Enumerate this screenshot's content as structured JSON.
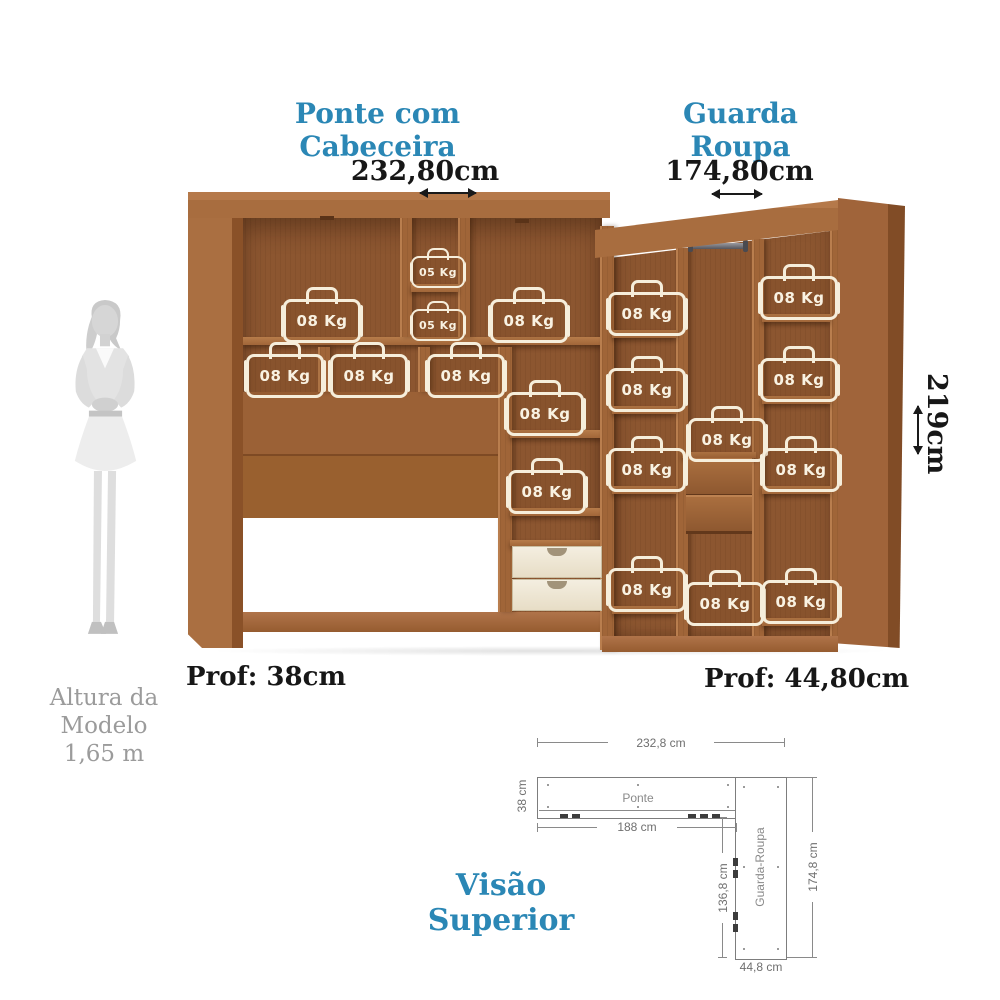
{
  "headings": {
    "ponte": "Ponte com Cabeceira",
    "guarda": "Guarda Roupa"
  },
  "dimensions": {
    "ponte_width": "232,80cm",
    "guarda_width": "174,80cm",
    "height": "219cm",
    "ponte_depth": "Prof: 38cm",
    "guarda_depth": "Prof: 44,80cm"
  },
  "model_note": {
    "line1": "Altura da",
    "line2": "Modelo",
    "line3": "1,65 m"
  },
  "bags": [
    {
      "label": "05 Kg"
    },
    {
      "label": "05 Kg"
    },
    {
      "label": "08 Kg"
    },
    {
      "label": "08 Kg"
    },
    {
      "label": "08 Kg"
    },
    {
      "label": "08 Kg"
    },
    {
      "label": "08 Kg"
    },
    {
      "label": "08 Kg"
    },
    {
      "label": "08 Kg"
    },
    {
      "label": "08 Kg"
    },
    {
      "label": "08 Kg"
    },
    {
      "label": "08 Kg"
    },
    {
      "label": "08 Kg"
    },
    {
      "label": "08 Kg"
    },
    {
      "label": "08 Kg"
    },
    {
      "label": "08 Kg"
    },
    {
      "label": "08 Kg"
    },
    {
      "label": "08 Kg"
    },
    {
      "label": "08 Kg"
    }
  ],
  "top_view": {
    "title": "Visão Superior",
    "ponte_label": "Ponte",
    "guarda_label": "Guarda-Roupa",
    "total_width": "232,8 cm",
    "ponte_depth": "38 cm",
    "ponte_inner_width": "188 cm",
    "guarda_inner_height": "136,8 cm",
    "guarda_total_height": "174,8 cm",
    "guarda_depth": "44,8 cm"
  },
  "colors": {
    "accent": "#2b87b5",
    "text": "#171717",
    "wood_light": "#a86d3f",
    "wood_dark": "#8c5630",
    "cream": "#eae1cd",
    "note_gray": "#9b9b9b",
    "diagram_line": "#8a8a8a"
  }
}
